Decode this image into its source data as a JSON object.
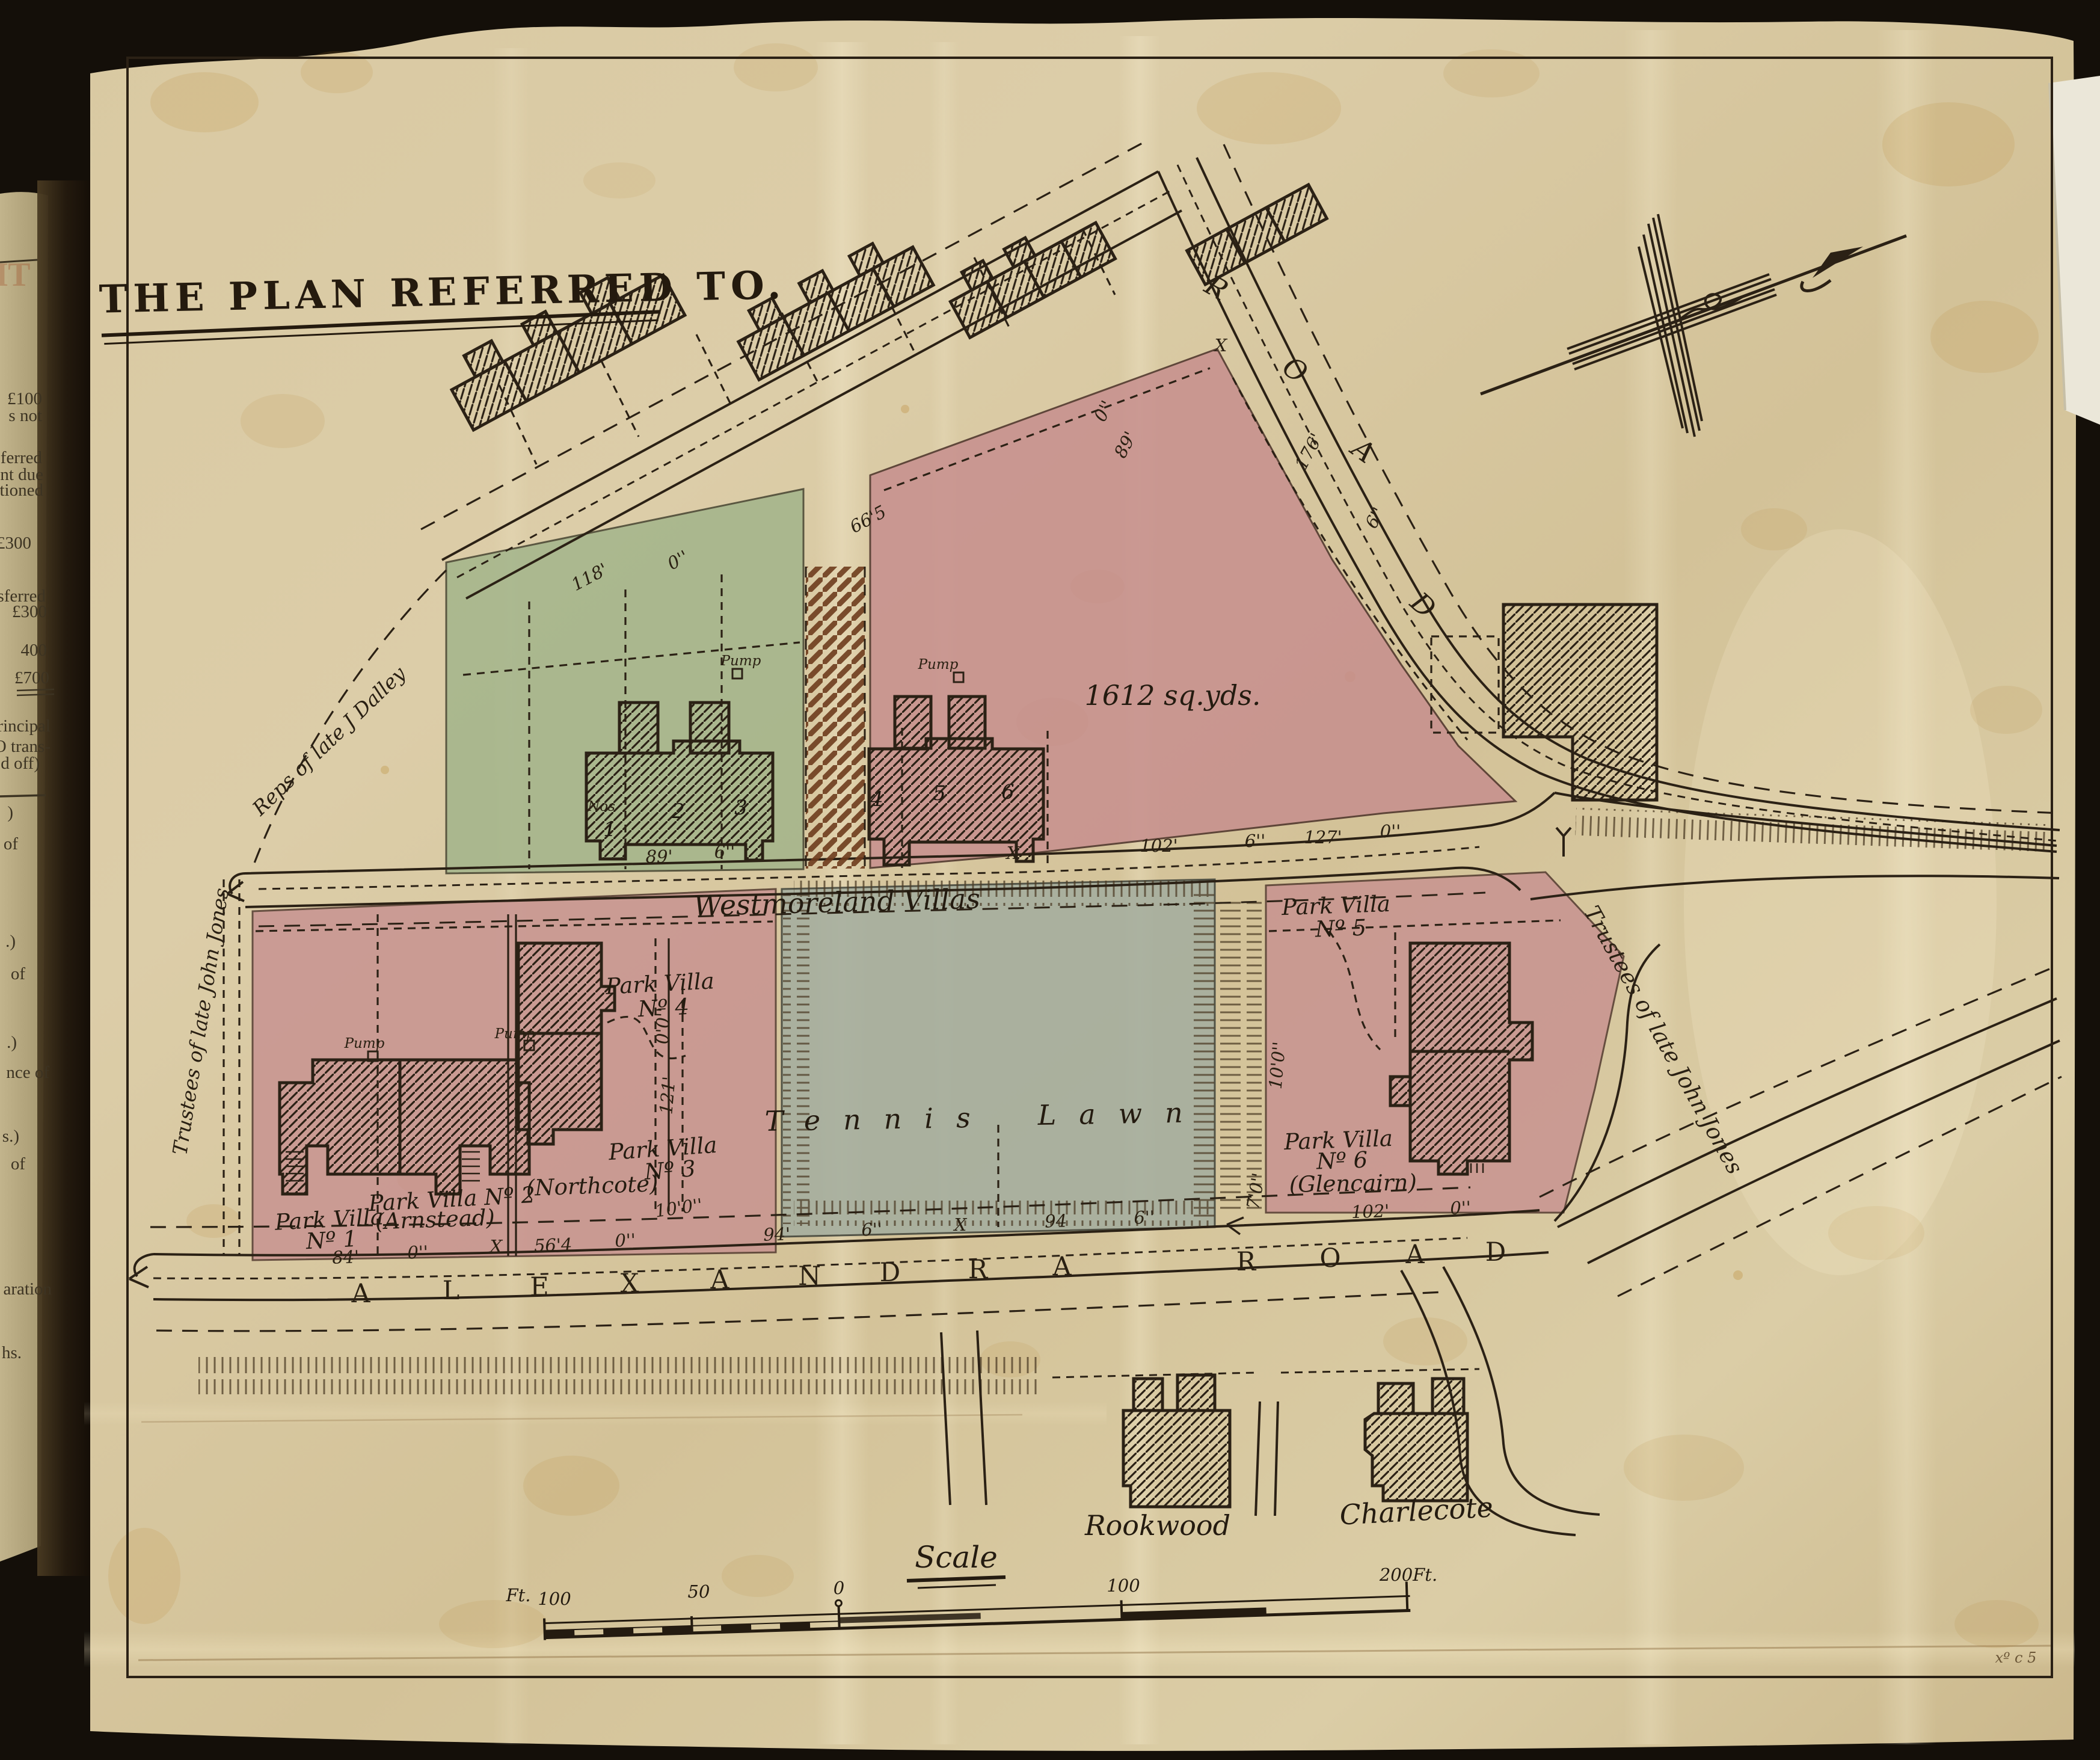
{
  "title": "THE PLAN REFERRED TO.",
  "owners": {
    "dalley": "Reps of late J Dalley",
    "jones_left": "Trustees of late John Jones",
    "jones_right": "Trustees of late John Jones"
  },
  "parcels": {
    "area_1612": "1612 sq.yds.",
    "westmoreland": "Westmoreland Villas",
    "tennis": "Tennis",
    "lawn": "Lawn"
  },
  "villas": {
    "park_villa": "Park Villa",
    "nos": "Nos",
    "n1": "1",
    "n2": "2",
    "n3": "3",
    "n4": "4",
    "n5": "5",
    "n6": "6",
    "no1": "Nº 1",
    "no2_line": "Park Villa Nº 2",
    "no3": "Nº 3",
    "no4": "Nº 4",
    "no5": "Nº 5",
    "no6": "Nº 6",
    "arnstead": "(Arnstead)",
    "northcote": "(Northcote)",
    "glencairn": "(Glencairn)",
    "pump": "Pump"
  },
  "houses": {
    "rookwood": "Rookwood",
    "charlecote": "Charlecote"
  },
  "roads": {
    "alexandra": [
      "A",
      "L",
      "E",
      "X",
      "A",
      "N",
      "D",
      "R",
      "A"
    ],
    "road": [
      "R",
      "O",
      "A",
      "D"
    ],
    "side_road": [
      "R",
      "O",
      "A",
      "D"
    ]
  },
  "dims": {
    "d118": "118'",
    "d0a": "0''",
    "d665": "66'5",
    "d89n": "89'",
    "d0n": "0''",
    "d176": "176'",
    "d6n": "6''",
    "d89": "89'",
    "d6a": "6''",
    "xa": "X",
    "d102": "102'",
    "d6b": "6''",
    "d127": "127'",
    "d0b": "0''",
    "d00": "0'0''",
    "d121": "121'",
    "d100": "10'0''",
    "d84": "84'",
    "d0c": "0''",
    "xb": "X",
    "d564": "56'4",
    "d0d": "0''",
    "d94a": "94'",
    "d6c": "6''",
    "xc": "X",
    "d94b": "94",
    "d6d": "6''",
    "d102b": "102'",
    "d0e": "0''",
    "d70": "7'0''",
    "d100b": "10'0''",
    "xd": "X"
  },
  "scale": {
    "heading": "Scale",
    "ft": "Ft.",
    "n100l": "100",
    "n50": "50",
    "n0": "0",
    "n100r": "100",
    "n200": "200Ft."
  },
  "margin": {
    "stamp": "HT",
    "fragments": [
      "£100",
      "s  not",
      "ferred",
      "nt due",
      "tioned",
      "£300",
      "sferred",
      "£300",
      "400",
      "£700",
      "rincipal",
      "O trans-",
      "d off)",
      ")",
      "of",
      ".)",
      "of",
      ".)",
      "nce of",
      "s.)",
      "of",
      "aration",
      "hs."
    ]
  },
  "plate_mark": "xº c 5"
}
